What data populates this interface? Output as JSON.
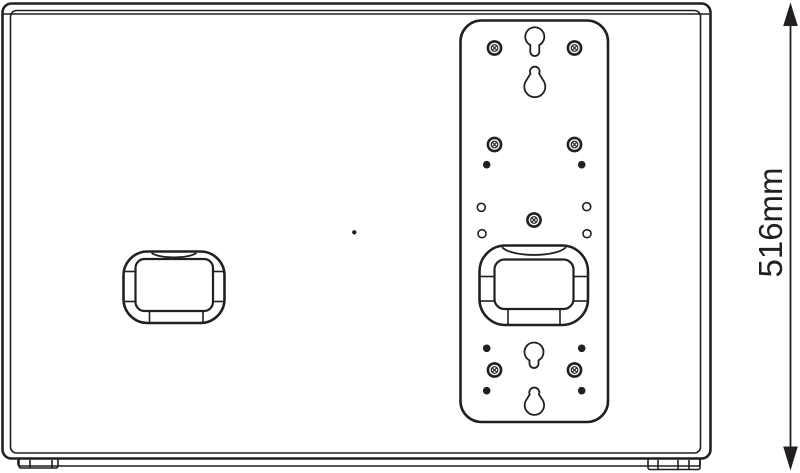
{
  "diagram": {
    "subject": "loudspeaker-rear-panel-technical-drawing",
    "background_color": "#ffffff",
    "line_color": "#231f20",
    "dimension": {
      "label": "516mm",
      "value": 516,
      "unit": "mm",
      "orientation": "vertical",
      "position": "right-edge"
    },
    "features": {
      "mount_plate_keyholes": 4,
      "mount_plate_screws": 7,
      "mount_plate_pilot_dots": 6,
      "mount_plate_open_holes": 4,
      "recessed_handles": 2,
      "bottom_feet_pads": 2
    }
  }
}
